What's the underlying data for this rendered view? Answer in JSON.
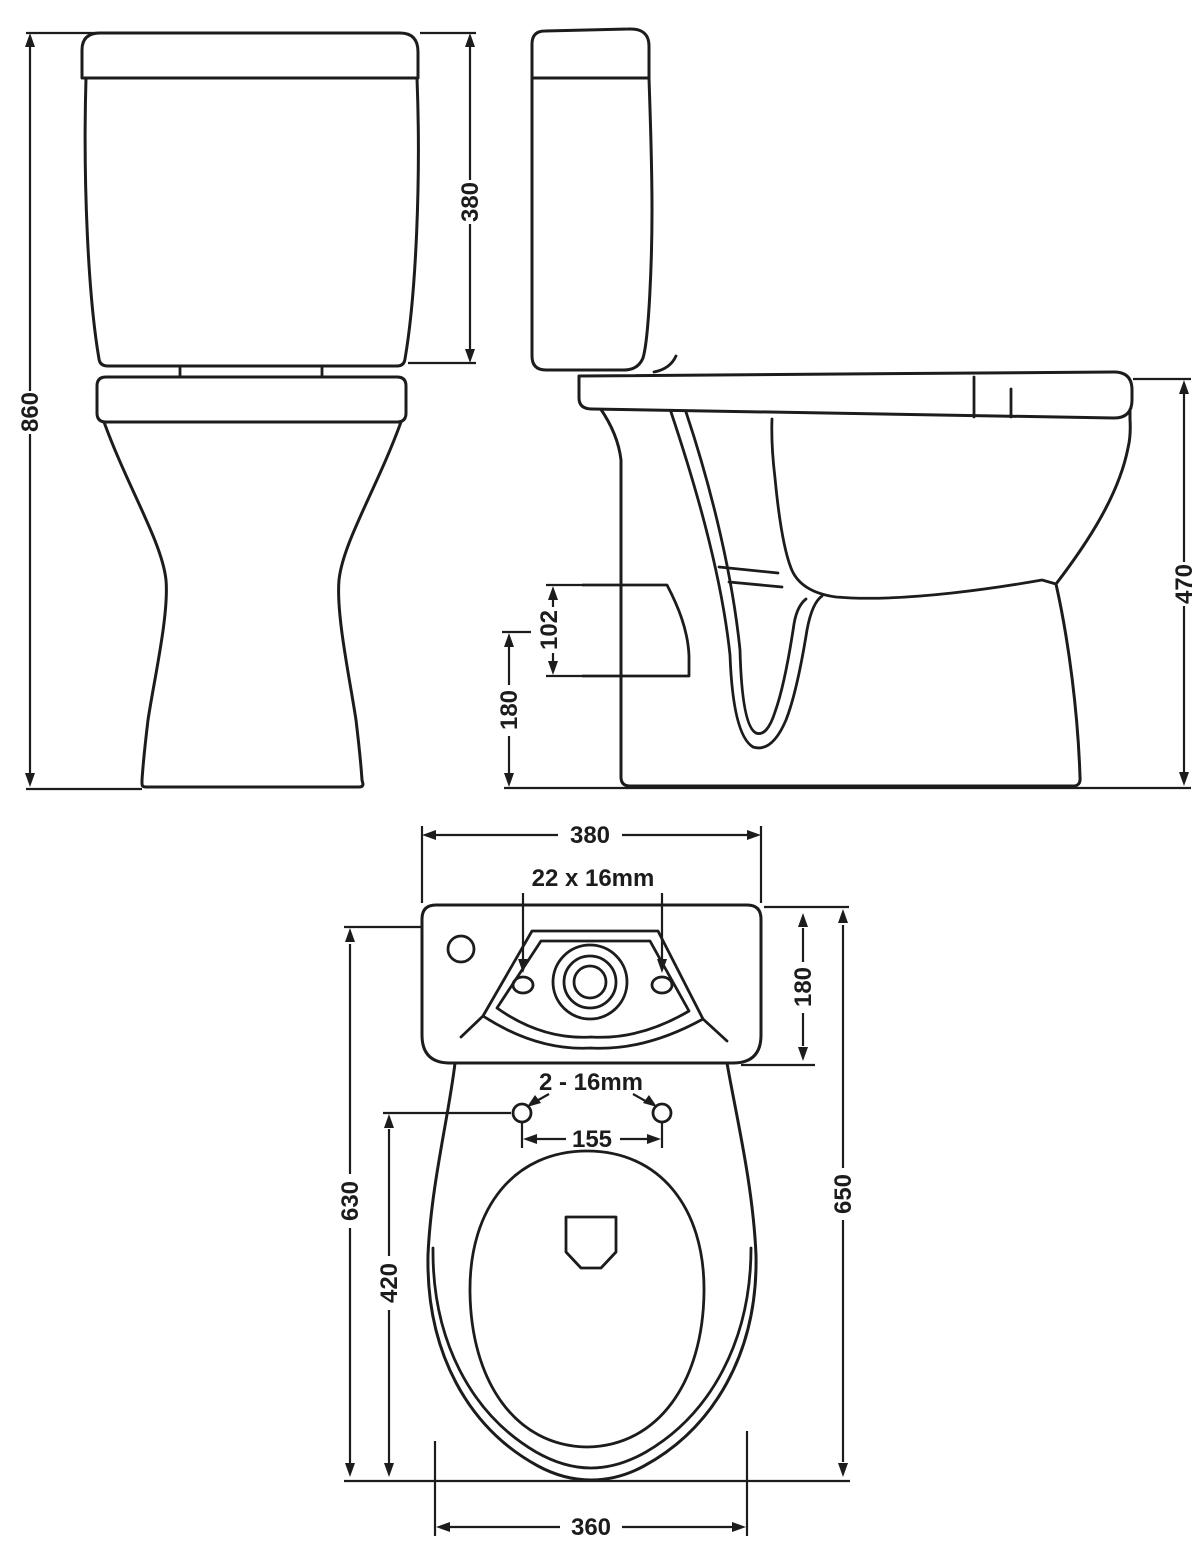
{
  "drawing_title": "Close coupled toilet dimension drawing",
  "colors": {
    "line": "#1c1c1c",
    "background": "#ffffff"
  },
  "views": {
    "front": {
      "labels": {
        "overall_height": "860",
        "cistern_height": "380"
      }
    },
    "side": {
      "labels": {
        "seat_height": "470",
        "outlet_size": "102",
        "outlet_centre_height": "180"
      }
    },
    "top": {
      "labels": {
        "cistern_width": "380",
        "cistern_fixing_holes": "22 x 16mm",
        "cistern_depth": "180",
        "seat_fixing_holes": "2 - 16mm",
        "seat_hole_centres": "155",
        "depth_to_seat_holes": "630",
        "pan_inner_length": "420",
        "overall_depth": "650",
        "base_width": "360"
      }
    }
  }
}
